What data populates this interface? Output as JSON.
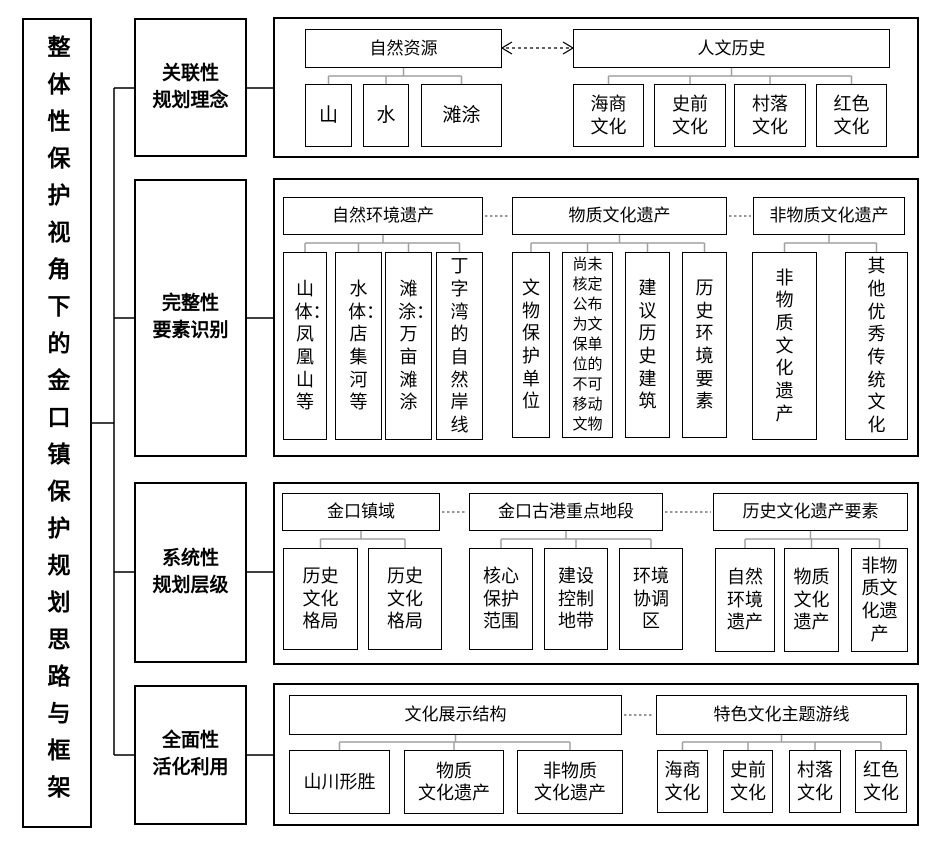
{
  "root": {
    "title": "整体性保护视角下的金口镇保护规划思路与框架"
  },
  "stages": [
    {
      "label": "关联性\n规划理念"
    },
    {
      "label": "完整性\n要素识别"
    },
    {
      "label": "系统性\n规划层级"
    },
    {
      "label": "全面性\n活化利用"
    }
  ],
  "panels": [
    {
      "groups": [
        {
          "header": "自然资源",
          "children": [
            "山",
            "水",
            "滩涂"
          ]
        },
        {
          "header": "人文历史",
          "children": [
            "海商文化",
            "史前文化",
            "村落文化",
            "红色文化"
          ]
        }
      ]
    },
    {
      "groups": [
        {
          "header": "自然环境遗产",
          "children": [
            "山体：凤凰山等",
            "水体：店集河等",
            "滩涂：万亩滩涂",
            "丁字湾的自然岸线"
          ]
        },
        {
          "header": "物质文化遗产",
          "children": [
            "文物保护单位",
            "尚未核定公布为文保单位的不可移动文物",
            "建议历史建筑",
            "历史环境要素"
          ]
        },
        {
          "header": "非物质文化遗产",
          "children": [
            "非物质文化遗产",
            "其他优秀传统文化"
          ]
        }
      ]
    },
    {
      "groups": [
        {
          "header": "金口镇域",
          "children": [
            "历史文化格局",
            "历史文化格局"
          ]
        },
        {
          "header": "金口古港重点地段",
          "children": [
            "核心保护范围",
            "建设控制地带",
            "环境协调区"
          ]
        },
        {
          "header": "历史文化遗产要素",
          "children": [
            "自然环境遗产",
            "物质文化遗产",
            "非物质文化遗产"
          ]
        }
      ]
    },
    {
      "groups": [
        {
          "header": "文化展示结构",
          "children": [
            "山川形胜",
            "物质\n文化遗产",
            "非物质\n文化遗产"
          ]
        },
        {
          "header": "特色文化主题游线",
          "children": [
            "海商文化",
            "史前文化",
            "村落文化",
            "红色文化"
          ]
        }
      ]
    }
  ],
  "colors": {
    "border": "#000000",
    "tree_connector": "#a0a0a0",
    "dotted_link": "#595959",
    "background": "#ffffff"
  }
}
